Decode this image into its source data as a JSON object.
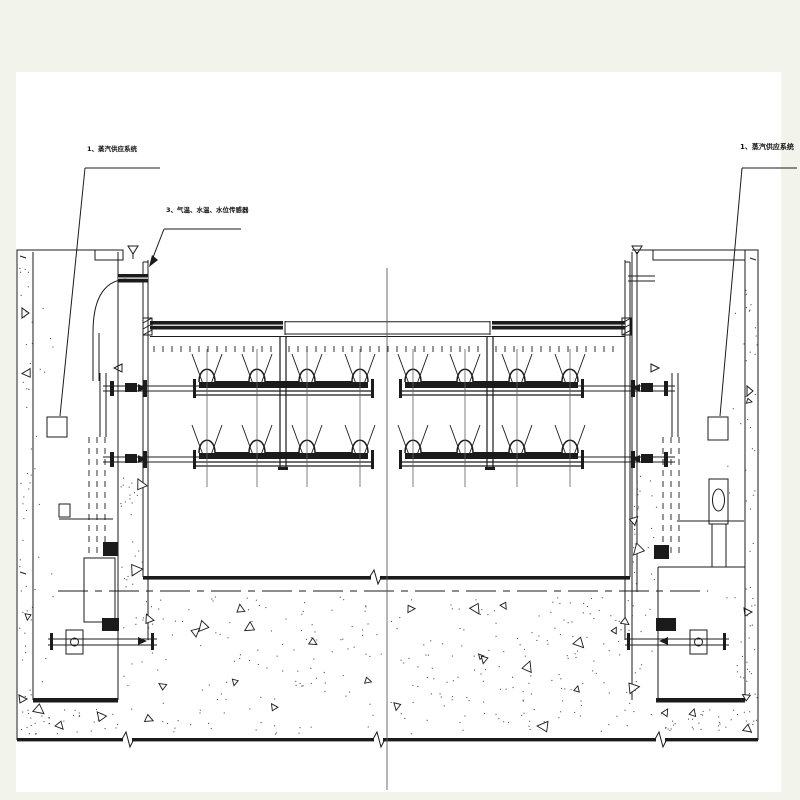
{
  "drawing": {
    "type": "engineering-cross-section",
    "annotations": {
      "steam_left": {
        "label": "1、蒸汽供应系统"
      },
      "sensors": {
        "label": "3、气温、水温、水位传感器"
      },
      "steam_right": {
        "label": "1、蒸汽供应系统"
      }
    },
    "symbols": {
      "water_level_mark": "▽",
      "flow_arrow": "►",
      "section_break": "zigzag"
    },
    "colors": {
      "paper": "#ffffff",
      "margin": "#f2f4ec",
      "ink": "#1b1b1b",
      "thin_line": "#5f5f5f"
    }
  }
}
